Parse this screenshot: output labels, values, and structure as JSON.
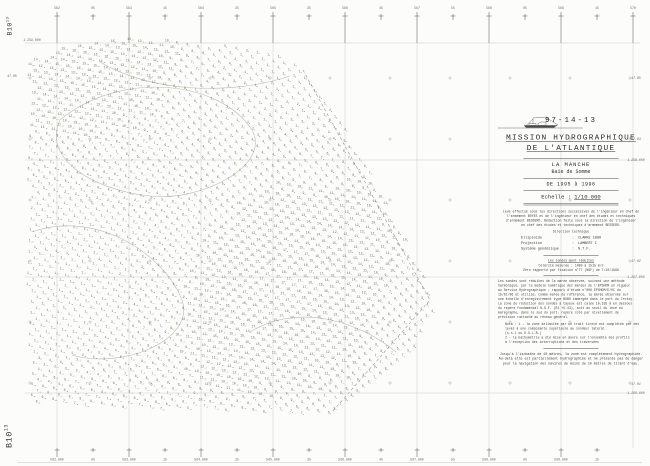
{
  "sheet": {
    "kind": "Feuille de sondes - minute de bathymétrie (scanned hydrographic sounding sheet)",
    "corner_label": {
      "text": "B10",
      "sup": "13"
    }
  },
  "title_block": {
    "report_number": "97-14-13",
    "title_line1": "MISSION HYDROGRAPHIQUE",
    "title_line2": "DE L'ATLANTIQUE",
    "area_line1": "LA MANCHE",
    "area_line2": "Baie de Somme",
    "period": "DE 1995 à 1996",
    "scale_label": "Echelle :",
    "scale_value": "1/10 000",
    "credits": [
      "Levé effectué sous les directions successives de l'ingénieur en chef de",
      "l'armement BOYES et de l'ingénieur en chef des études et techniques",
      "d'armement BESSERO. Rédaction faite sous la direction de l'ingénieur",
      "en chef des études et techniques d'armement BESSERO."
    ],
    "direction_label": "Direction technique",
    "geodesy": [
      {
        "label": "Ellipsoïde",
        "value": "CLARKE 1880"
      },
      {
        "label": "Projection",
        "value": "LAMBERT I"
      },
      {
        "label": "Système géodésique",
        "value": "N.T.F."
      }
    ],
    "soundings_header": "Les sondes sont réduites",
    "soundings_lines": [
      "Célérité mesurée : 1480 à 1515 m/s",
      "Zéro rapporté par fixation n°77 (NGF) de 7/10/1996"
    ],
    "description": [
      "Les sondes sont réduites de la marée observée, suivant une méthode",
      "harmonique, par le modèle numérique des marées de l'EPSHOM en vigueur",
      "au Service Hydrographique ; rapport d'étude n°008 EPSHOM/E/OC du",
      "15/01/96 et utilisé, comme marée de référence, la marée observée sur",
      "une échelle d'enregistrement type BOBO immergée dans le port du Crotoy.",
      "La zone de réduction des sondes à Cayeux est calée 10,335 m en dessous",
      "du repère fondamental N.G.F. (Ri +5.43), soit au seuil du levé du",
      "marégraphe, dans le sud du port, repère coté par nivellement de",
      "précision rattaché au réseau général."
    ],
    "nota": [
      "Nota : 1 - la zone délimitée par un trait tireté est complétée par des",
      "           levés à une composante supérieure au sondeur latéral",
      "           (s.s.l ou D.S.L.B.)",
      "       2 - la bathymétrie a été mise en œuvre sur l'ensemble des profils",
      "           à l'exception des interruptions et des traversées"
    ],
    "footer": [
      "Jusqu'à l'isobathe de 10 mètres, la zone est complètement hydrographiée.",
      "Au-delà elle est partiellement hydrographiée et ne présente pas de danger",
      "pour la navigation des navires de moins de 10 mètres de tirant d'eau."
    ]
  },
  "geo": {
    "frame": {
      "x0": 28,
      "x1": 640,
      "y0": 43,
      "y1": 448
    },
    "vertical_lines_x": [
      57,
      129,
      201,
      273,
      345,
      417,
      489,
      561,
      633
    ],
    "horizontal_lines_y": [
      43,
      160,
      277,
      393
    ],
    "cross_grid": {
      "x0": 30,
      "dx": 60,
      "nx": 11,
      "y0": 78,
      "dy": 61,
      "ny": 6
    },
    "top_ticks": [
      {
        "x": 57,
        "long": true,
        "label": "562"
      },
      {
        "x": 93,
        "long": false,
        "label": "05"
      },
      {
        "x": 129,
        "long": true,
        "label": "563"
      },
      {
        "x": 165,
        "long": false,
        "label": "15"
      },
      {
        "x": 201,
        "long": true,
        "label": "564"
      },
      {
        "x": 237,
        "long": false,
        "label": "25"
      },
      {
        "x": 273,
        "long": true,
        "label": "565"
      },
      {
        "x": 309,
        "long": false,
        "label": "35"
      },
      {
        "x": 345,
        "long": true,
        "label": "566"
      },
      {
        "x": 381,
        "long": false,
        "label": "45"
      },
      {
        "x": 417,
        "long": true,
        "label": "567"
      },
      {
        "x": 453,
        "long": false,
        "label": "55"
      },
      {
        "x": 489,
        "long": true,
        "label": "568"
      },
      {
        "x": 525,
        "long": false,
        "label": "05"
      },
      {
        "x": 561,
        "long": true,
        "label": "569"
      },
      {
        "x": 597,
        "long": false,
        "label": "15"
      },
      {
        "x": 633,
        "long": true,
        "label": "570"
      }
    ],
    "bottom_ticks": [
      {
        "x": 57,
        "long": true,
        "label": "562.000"
      },
      {
        "x": 93,
        "long": false,
        "label": "05"
      },
      {
        "x": 129,
        "long": true,
        "label": "563.000"
      },
      {
        "x": 165,
        "long": false,
        "label": "15"
      },
      {
        "x": 201,
        "long": true,
        "label": "564.000"
      },
      {
        "x": 237,
        "long": false,
        "label": "25"
      },
      {
        "x": 273,
        "long": true,
        "label": "565.000"
      },
      {
        "x": 309,
        "long": false,
        "label": "35"
      },
      {
        "x": 345,
        "long": true,
        "label": "566.000"
      },
      {
        "x": 381,
        "long": false,
        "label": "45"
      },
      {
        "x": 417,
        "long": true,
        "label": "567.000"
      },
      {
        "x": 453,
        "long": false,
        "label": "55"
      },
      {
        "x": 489,
        "long": true,
        "label": "568.000"
      },
      {
        "x": 525,
        "long": false,
        "label": "05"
      },
      {
        "x": 561,
        "long": true,
        "label": "569.000"
      },
      {
        "x": 597,
        "long": false,
        "label": "15"
      }
    ],
    "right_labels": [
      {
        "y": 78,
        "label": "47.05"
      },
      {
        "y": 139,
        "label": "47.04"
      },
      {
        "y": 160,
        "label": "1.258.000"
      },
      {
        "y": 261,
        "label": "47.02"
      },
      {
        "y": 277,
        "label": "1.257.000"
      },
      {
        "y": 384,
        "label": "47.01"
      },
      {
        "y": 393,
        "label": "1.256.000"
      }
    ],
    "left_labels": [
      {
        "x": 24,
        "y": 40,
        "label": "1.259.000"
      },
      {
        "x": 4,
        "y": 76,
        "label": "47.05"
      }
    ]
  },
  "soundings": {
    "description": "depth soundings in metres with decimal subscripts, along survey lines",
    "polygon": [
      [
        27,
        62
      ],
      [
        70,
        45
      ],
      [
        130,
        38
      ],
      [
        205,
        44
      ],
      [
        262,
        52
      ],
      [
        300,
        63
      ],
      [
        318,
        88
      ],
      [
        345,
        130
      ],
      [
        372,
        178
      ],
      [
        402,
        238
      ],
      [
        428,
        288
      ],
      [
        432,
        312
      ],
      [
        415,
        345
      ],
      [
        385,
        378
      ],
      [
        352,
        402
      ],
      [
        332,
        415
      ],
      [
        260,
        413
      ],
      [
        160,
        410
      ],
      [
        70,
        407
      ],
      [
        30,
        402
      ],
      [
        26,
        300
      ]
    ],
    "angle_deg": -38,
    "step": 7.2,
    "row_gap": 8.2,
    "depth_min": 1,
    "depth_max": 17
  },
  "contours": [
    "M 60 120 C 120 70 220 80 252 130 C 272 166 200 202 150 196 C 92 190 42 158 60 120",
    "M 32 232 C 92 210 162 250 182 300 C 196 340 122 370 72 355",
    "M 250 332 C 300 302 360 322 396 352",
    "M 100 62 C 150 92 230 96 290 76"
  ],
  "boundary_dash": "M 303 70 L 430 300 L 332 412",
  "colors": {
    "paper": "#fcfcfa",
    "ink": "#2f2f2b",
    "grid": "#cfcfc3",
    "tick": "#6d6d64",
    "sounding": "#73736a",
    "contour": "#bcbcb0"
  }
}
